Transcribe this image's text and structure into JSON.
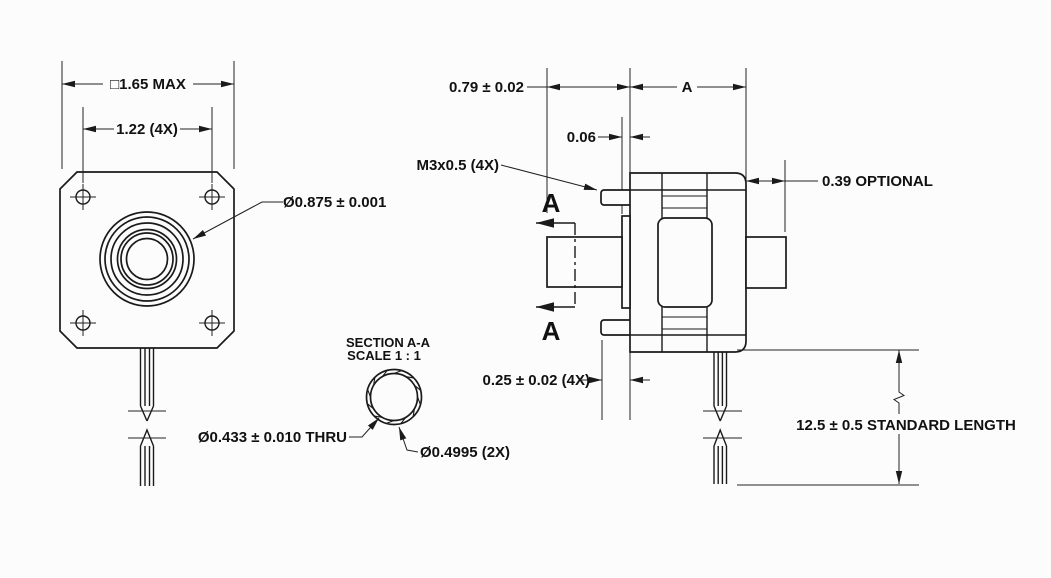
{
  "colors": {
    "background": "#fcfcfc",
    "line": "#1a1a1a",
    "text": "#111111"
  },
  "front_view": {
    "dim_flange_size": "□1.65 MAX",
    "dim_hole_spacing": "1.22 (4X)",
    "leader_pilot_diameter": "Ø0.875 ± 0.001"
  },
  "section_view": {
    "title": "SECTION A-A",
    "scale": "SCALE 1 : 1",
    "leader_bore": "Ø0.433 ± 0.010 THRU",
    "leader_outer_diameter": "Ø0.4995 (2X)"
  },
  "side_view": {
    "dim_shaft_extension": "0.79 ± 0.02",
    "dim_motor_length": "A",
    "dim_pilot_height": "0.06",
    "leader_thread": "M3x0.5 (4X)",
    "dim_rear_shaft": "0.39 OPTIONAL",
    "dim_mount_ear": "0.25 ± 0.02 (4X)",
    "dim_lead_length": "12.5 ± 0.5 STANDARD LENGTH",
    "section_arrow_label": "A"
  }
}
